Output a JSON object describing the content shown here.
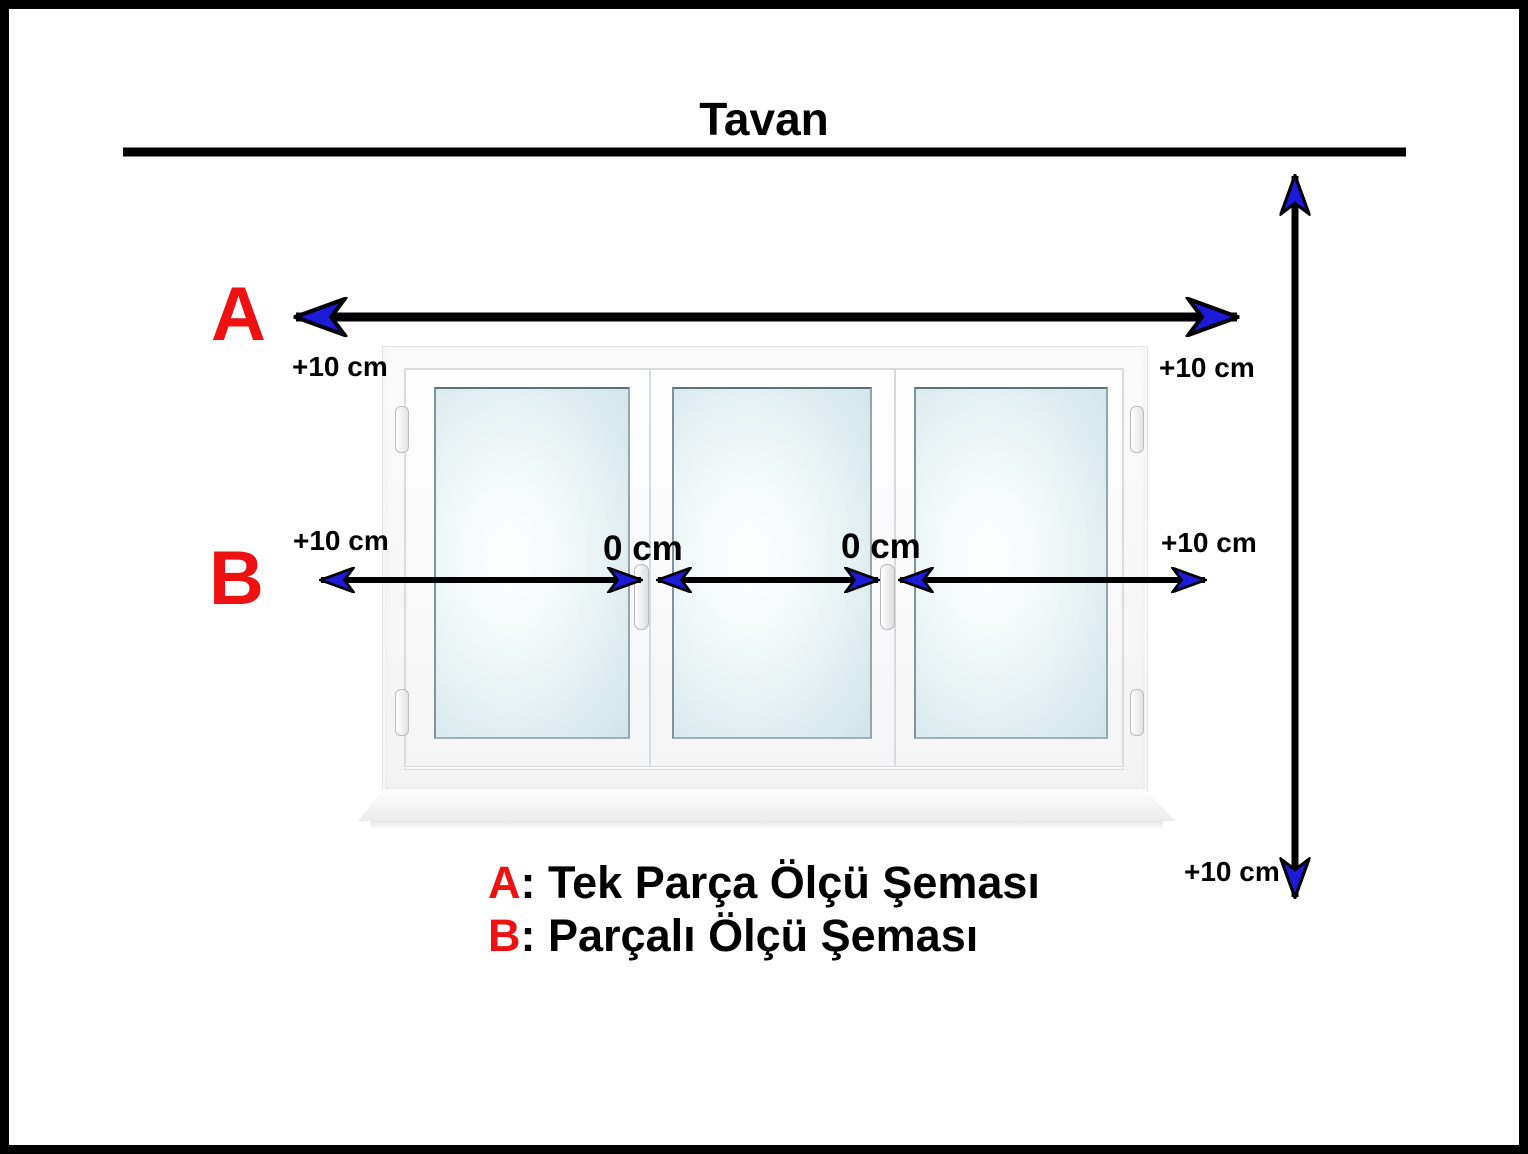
{
  "title": "Tavan",
  "labels": {
    "a": "A",
    "b": "B",
    "plus10": "+10 cm",
    "zero": "0 cm"
  },
  "legend": [
    {
      "letter": "A",
      "text": ": Tek Parça Ölçü Şeması"
    },
    {
      "letter": "B",
      "text": ": Parçalı Ölçü Şeması"
    }
  ],
  "colors": {
    "red": "#ee1111",
    "blue": "#1b1bd8",
    "black": "#000000"
  }
}
